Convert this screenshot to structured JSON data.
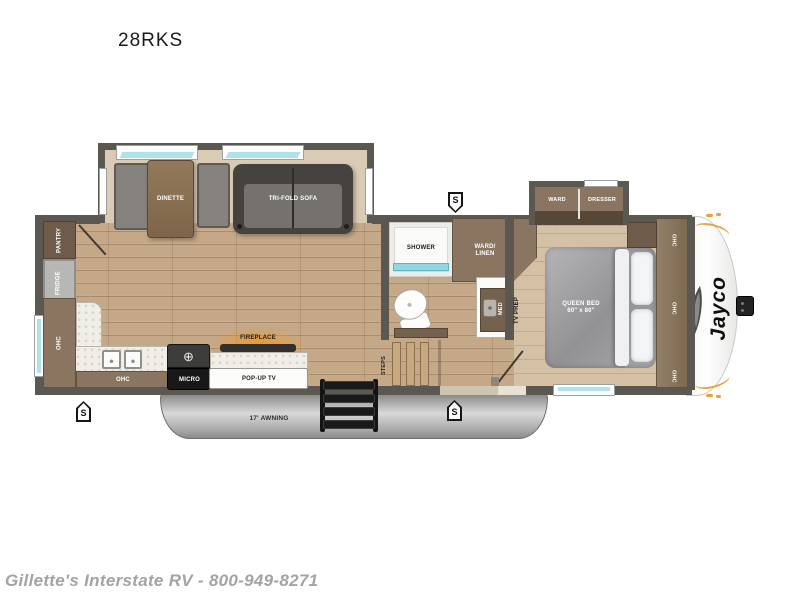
{
  "title": "28RKS",
  "footer": "Gillette's Interstate RV - 800-949-8271",
  "brand": "Jayco",
  "markers": {
    "speaker": "S"
  },
  "living": {
    "dinette": "DINETTE",
    "tri_fold_sofa": "TRI-FOLD SOFA"
  },
  "kitchen": {
    "pantry": "PANTRY",
    "fridge": "FRIDGE",
    "ohc_rear": "OHC",
    "ohc_base": "OHC",
    "micro": "MICRO",
    "fireplace": "FIREPLACE",
    "pop_up_tv": "POP-UP TV"
  },
  "bath": {
    "shower": "SHOWER",
    "ward_linen": "WARD/\nLINEN",
    "med": "MED",
    "steps": "STEPS"
  },
  "bedroom": {
    "tv_prep": "TV PREP",
    "ward": "WARD",
    "dresser": "DRESSER",
    "queen_bed": "QUEEN BED\n60\" x 80\"",
    "ohc": [
      "OHC",
      "OHC",
      "OHC"
    ]
  },
  "exterior": {
    "awning": "17' AWNING"
  },
  "colors": {
    "wall": "#5b5751",
    "floor_wood": "#c4a887",
    "slide_floor": "#dacbb5",
    "cabinet": "#8a7560",
    "accent_orange": "#e8a23c",
    "window_glass": "#aee3ee",
    "shower_glass": "#8fd8e2",
    "awning_gray": "#9c9c9c"
  }
}
